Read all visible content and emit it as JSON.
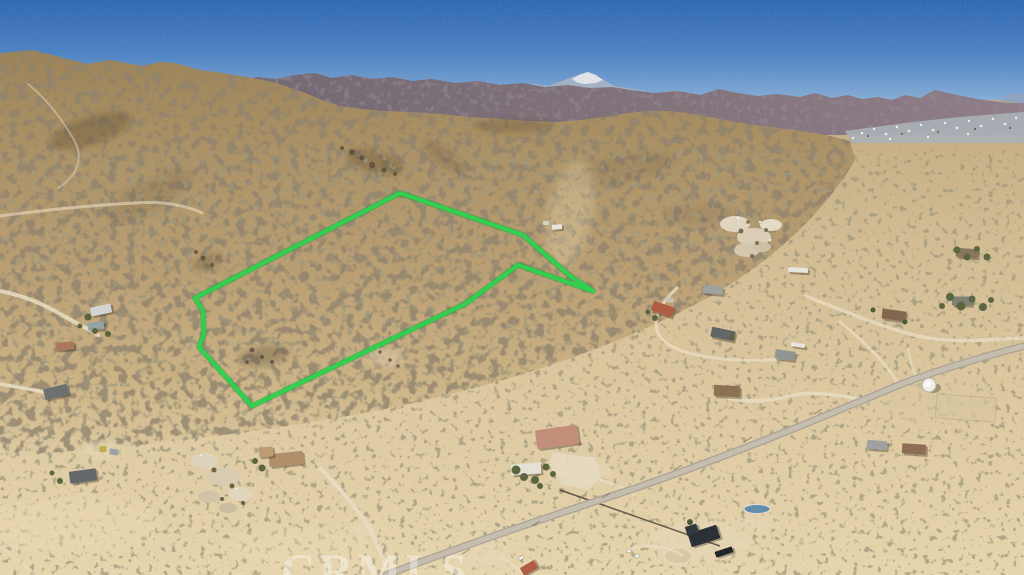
{
  "scene": {
    "type": "aerial-drone-photograph",
    "description": "Aerial photo of desert hillside land parcel outlined in green, with dirt roads, scattered desert homes, a paved road, water tank and mountain ranges on the horizon",
    "watermark": "CRMLS"
  },
  "palette": {
    "boundary_green": "#2fd14f",
    "sky_top": "#2b66b5",
    "sky_horizon": "#aac6e2",
    "far_range_haze": "#8fa3c2",
    "snow_peak": "#e6e9ee",
    "mid_range_purple": "#7d6f78",
    "hill_tan": "#b2966a",
    "plain_sand": "#ddc79f",
    "paved_road": "#c6bfb1",
    "dirt_road": "#ecdfc4",
    "town_strip": "#a8b1b9"
  },
  "property_boundary": {
    "stroke_color": "#2fd14f",
    "points": "400,193 523,235 570,276 593,291 518,265 465,304 252,406 199,347 204,333 203,311 195,298"
  },
  "roads": {
    "paved": [
      {
        "d": "M 386,575 C 470,543 560,513 630,490 C 740,452 830,414 899,385 C 940,369 990,355 1024,346",
        "w": 7.5
      }
    ],
    "dirt": [
      {
        "d": "M 0,291 C 20,295 42,303 62,315 C 76,323 90,330 98,335",
        "w": 4,
        "o": 0.85
      },
      {
        "d": "M 0,216 C 45,210 95,205 135,203 C 165,201 188,206 202,213",
        "w": 3,
        "o": 0.6
      },
      {
        "d": "M 28,84 C 48,100 64,122 74,140 C 84,158 78,176 58,188",
        "w": 2,
        "o": 0.45
      },
      {
        "d": "M 677,288 C 662,302 653,316 657,330 C 661,344 680,352 702,356 C 730,361 762,362 786,358",
        "w": 3,
        "o": 0.8
      },
      {
        "d": "M 729,398 C 750,403 772,401 790,396 C 812,390 840,396 862,399",
        "w": 3.5,
        "o": 0.85
      },
      {
        "d": "M 806,296 C 840,310 876,324 906,333 C 940,343 975,341 1002,339 L 1024,338",
        "w": 3.5,
        "o": 0.8
      },
      {
        "d": "M 899,385 C 886,362 862,340 840,322",
        "w": 3,
        "o": 0.75
      },
      {
        "d": "M 908,349 C 910,360 913,370 917,379",
        "w": 2.5,
        "o": 0.7
      },
      {
        "d": "M 321,469 C 340,489 357,508 367,524 C 375,538 382,557 389,575",
        "w": 4,
        "o": 0.9
      },
      {
        "d": "M 592,477 C 612,483 625,489 634,494",
        "w": 3,
        "o": 0.8
      },
      {
        "d": "M 0,384 C 16,387 30,389 44,392",
        "w": 3.5,
        "o": 0.9
      },
      {
        "d": "M 630,549 C 642,546 652,545 661,547 C 670,549 677,552 682,555",
        "w": 3,
        "o": 0.8
      },
      {
        "d": "M 500,556 C 508,561 515,567 521,572",
        "w": 3,
        "o": 0.8
      },
      {
        "d": "M 0,546 C 14,556 26,566 36,575",
        "w": 3,
        "o": 0.55
      }
    ]
  },
  "buildings": [
    {
      "x": 101,
      "y": 310,
      "w": 21,
      "h": 9,
      "r": -12,
      "c": "#d3d7d8"
    },
    {
      "x": 96,
      "y": 326,
      "w": 16,
      "h": 8,
      "r": -8,
      "c": "#8fa1a9"
    },
    {
      "x": 65,
      "y": 346,
      "w": 18,
      "h": 8,
      "r": -5,
      "c": "#a9765a"
    },
    {
      "x": 56,
      "y": 392,
      "w": 24,
      "h": 11,
      "r": -14,
      "c": "#686d70"
    },
    {
      "x": 83,
      "y": 476,
      "w": 27,
      "h": 12,
      "r": -8,
      "c": "#5f6467"
    },
    {
      "x": 103,
      "y": 449,
      "w": 7,
      "h": 6,
      "r": 0,
      "c": "#c3ad4d"
    },
    {
      "x": 114,
      "y": 452,
      "w": 9,
      "h": 6,
      "r": 8,
      "c": "#9aa0a4"
    },
    {
      "x": 286,
      "y": 459,
      "w": 34,
      "h": 13,
      "r": -6,
      "c": "#b08d67"
    },
    {
      "x": 266,
      "y": 452,
      "w": 14,
      "h": 10,
      "r": -6,
      "c": "#bd9b72"
    },
    {
      "x": 663,
      "y": 309,
      "w": 22,
      "h": 10,
      "r": 18,
      "c": "#b05840"
    },
    {
      "x": 670,
      "y": 300,
      "w": 8,
      "h": 5,
      "r": 18,
      "c": "#c9c3b5"
    },
    {
      "x": 723,
      "y": 334,
      "w": 24,
      "h": 10,
      "r": 12,
      "c": "#5d6364"
    },
    {
      "x": 713,
      "y": 290,
      "w": 20,
      "h": 8,
      "r": 5,
      "c": "#9ba1a1"
    },
    {
      "x": 785,
      "y": 355,
      "w": 20,
      "h": 9,
      "r": 8,
      "c": "#8e9395"
    },
    {
      "x": 798,
      "y": 345,
      "w": 14,
      "h": 4,
      "r": 8,
      "c": "#eceae4"
    },
    {
      "x": 727,
      "y": 391,
      "w": 26,
      "h": 11,
      "r": 3,
      "c": "#8a6e4d"
    },
    {
      "x": 557,
      "y": 437,
      "w": 42,
      "h": 19,
      "r": -8,
      "c": "#c28d78"
    },
    {
      "x": 526,
      "y": 469,
      "w": 30,
      "h": 11,
      "r": -4,
      "c": "#e7e4db"
    },
    {
      "x": 877,
      "y": 445,
      "w": 20,
      "h": 9,
      "r": 4,
      "c": "#9da1a4"
    },
    {
      "x": 914,
      "y": 449,
      "w": 24,
      "h": 10,
      "r": 4,
      "c": "#8a6a50"
    },
    {
      "x": 894,
      "y": 315,
      "w": 24,
      "h": 10,
      "r": 8,
      "c": "#7e6349"
    },
    {
      "x": 962,
      "y": 301,
      "w": 20,
      "h": 9,
      "r": 0,
      "c": "#7b7f73"
    },
    {
      "x": 967,
      "y": 253,
      "w": 22,
      "h": 9,
      "r": 4,
      "c": "#857259"
    },
    {
      "x": 704,
      "y": 536,
      "w": 30,
      "h": 14,
      "r": -18,
      "c": "#232833"
    },
    {
      "x": 692,
      "y": 530,
      "w": 12,
      "h": 10,
      "r": -18,
      "c": "#2b303b"
    },
    {
      "x": 724,
      "y": 552,
      "w": 18,
      "h": 6,
      "r": -18,
      "c": "#191c24"
    },
    {
      "x": 529,
      "y": 568,
      "w": 16,
      "h": 9,
      "r": -30,
      "c": "#b05841"
    },
    {
      "x": 798,
      "y": 270,
      "w": 20,
      "h": 5,
      "r": 3,
      "c": "#eae8e2"
    },
    {
      "x": 557,
      "y": 227,
      "w": 10,
      "h": 5,
      "r": -5,
      "c": "#eae8e1"
    },
    {
      "x": 546,
      "y": 223,
      "w": 6,
      "h": 4,
      "r": 0,
      "c": "#d9d5c9"
    }
  ],
  "vehicles": [
    {
      "x": 521,
      "y": 558,
      "r": -35
    },
    {
      "x": 629,
      "y": 551,
      "r": -20
    },
    {
      "x": 637,
      "y": 556,
      "r": -20
    }
  ],
  "water_tank": {
    "x": 929,
    "y": 385
  },
  "pond": {
    "x": 757,
    "y": 509
  }
}
